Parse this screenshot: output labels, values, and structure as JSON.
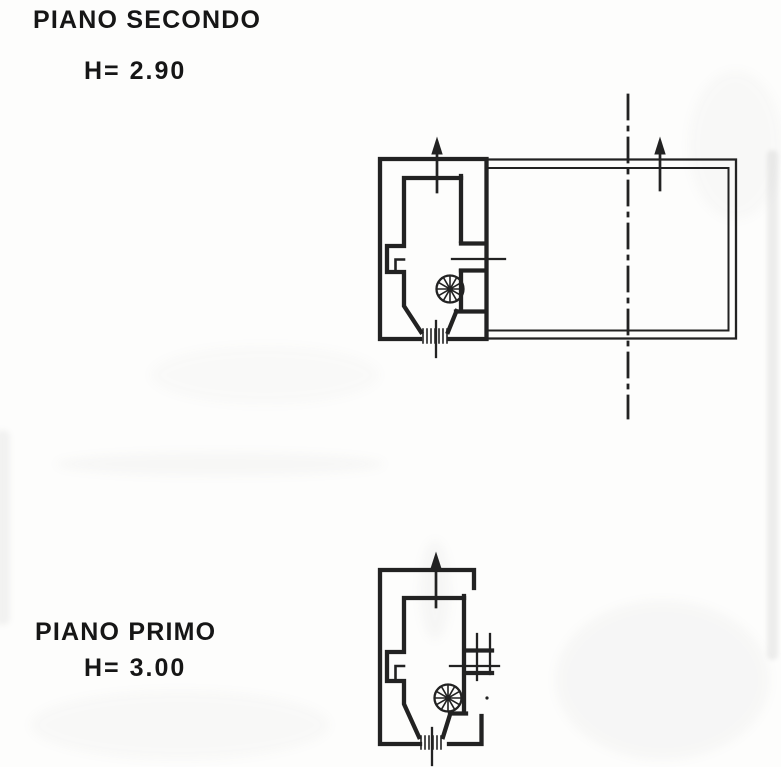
{
  "page": {
    "kind": "scanned architectural floor plan drawing",
    "paper_color": "#fdfdfc",
    "ink_color": "#222222"
  },
  "floors": [
    {
      "label": "PIANO SECONDO",
      "height_label": "H= 2.90",
      "plan_elements": [
        "stairwell-room",
        "spiral-staircase",
        "terrace",
        "niche",
        "window-sill",
        "entry-hatch",
        "up-arrow-stairwell",
        "up-arrow-terrace",
        "section-line"
      ]
    },
    {
      "label": "PIANO PRIMO",
      "height_label": "H= 3.00",
      "plan_elements": [
        "stairwell-room",
        "spiral-staircase",
        "niche",
        "window-bay",
        "entry-hatch",
        "up-arrow-stairwell"
      ]
    }
  ]
}
